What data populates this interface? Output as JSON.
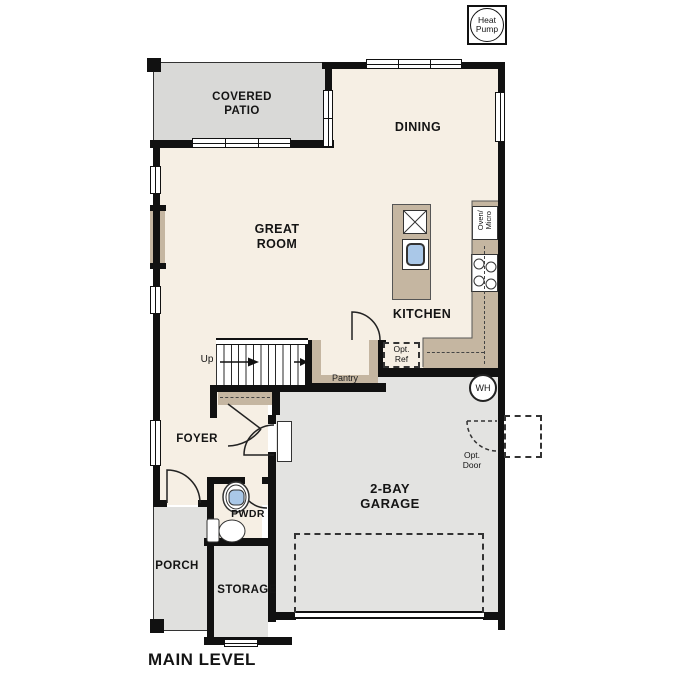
{
  "title": "MAIN LEVEL",
  "colors": {
    "wall": "#111111",
    "interior_cream": "#f6efe4",
    "patio_gray": "#d9d9d7",
    "garage_gray": "#e3e3e1",
    "counter_tan": "#c5b6a1",
    "sink_blue": "#aac8e8"
  },
  "rooms": {
    "covered_patio": "COVERED\nPATIO",
    "dining": "DINING",
    "great_room": "GREAT\nROOM",
    "kitchen": "KITCHEN",
    "pantry": "Pantry",
    "foyer": "FOYER",
    "pwdr": "PWDR",
    "porch": "PORCH",
    "storage": "STORAGE",
    "garage": "2-BAY\nGARAGE"
  },
  "annotations": {
    "heat_pump": "Heat\nPump",
    "water_heater": "WH",
    "up": "Up",
    "dishwasher": "DW",
    "oven_micro": "Oven/\nMicro",
    "opt_ref": "Opt.\nRef",
    "opt_door": "Opt.\nDoor"
  }
}
